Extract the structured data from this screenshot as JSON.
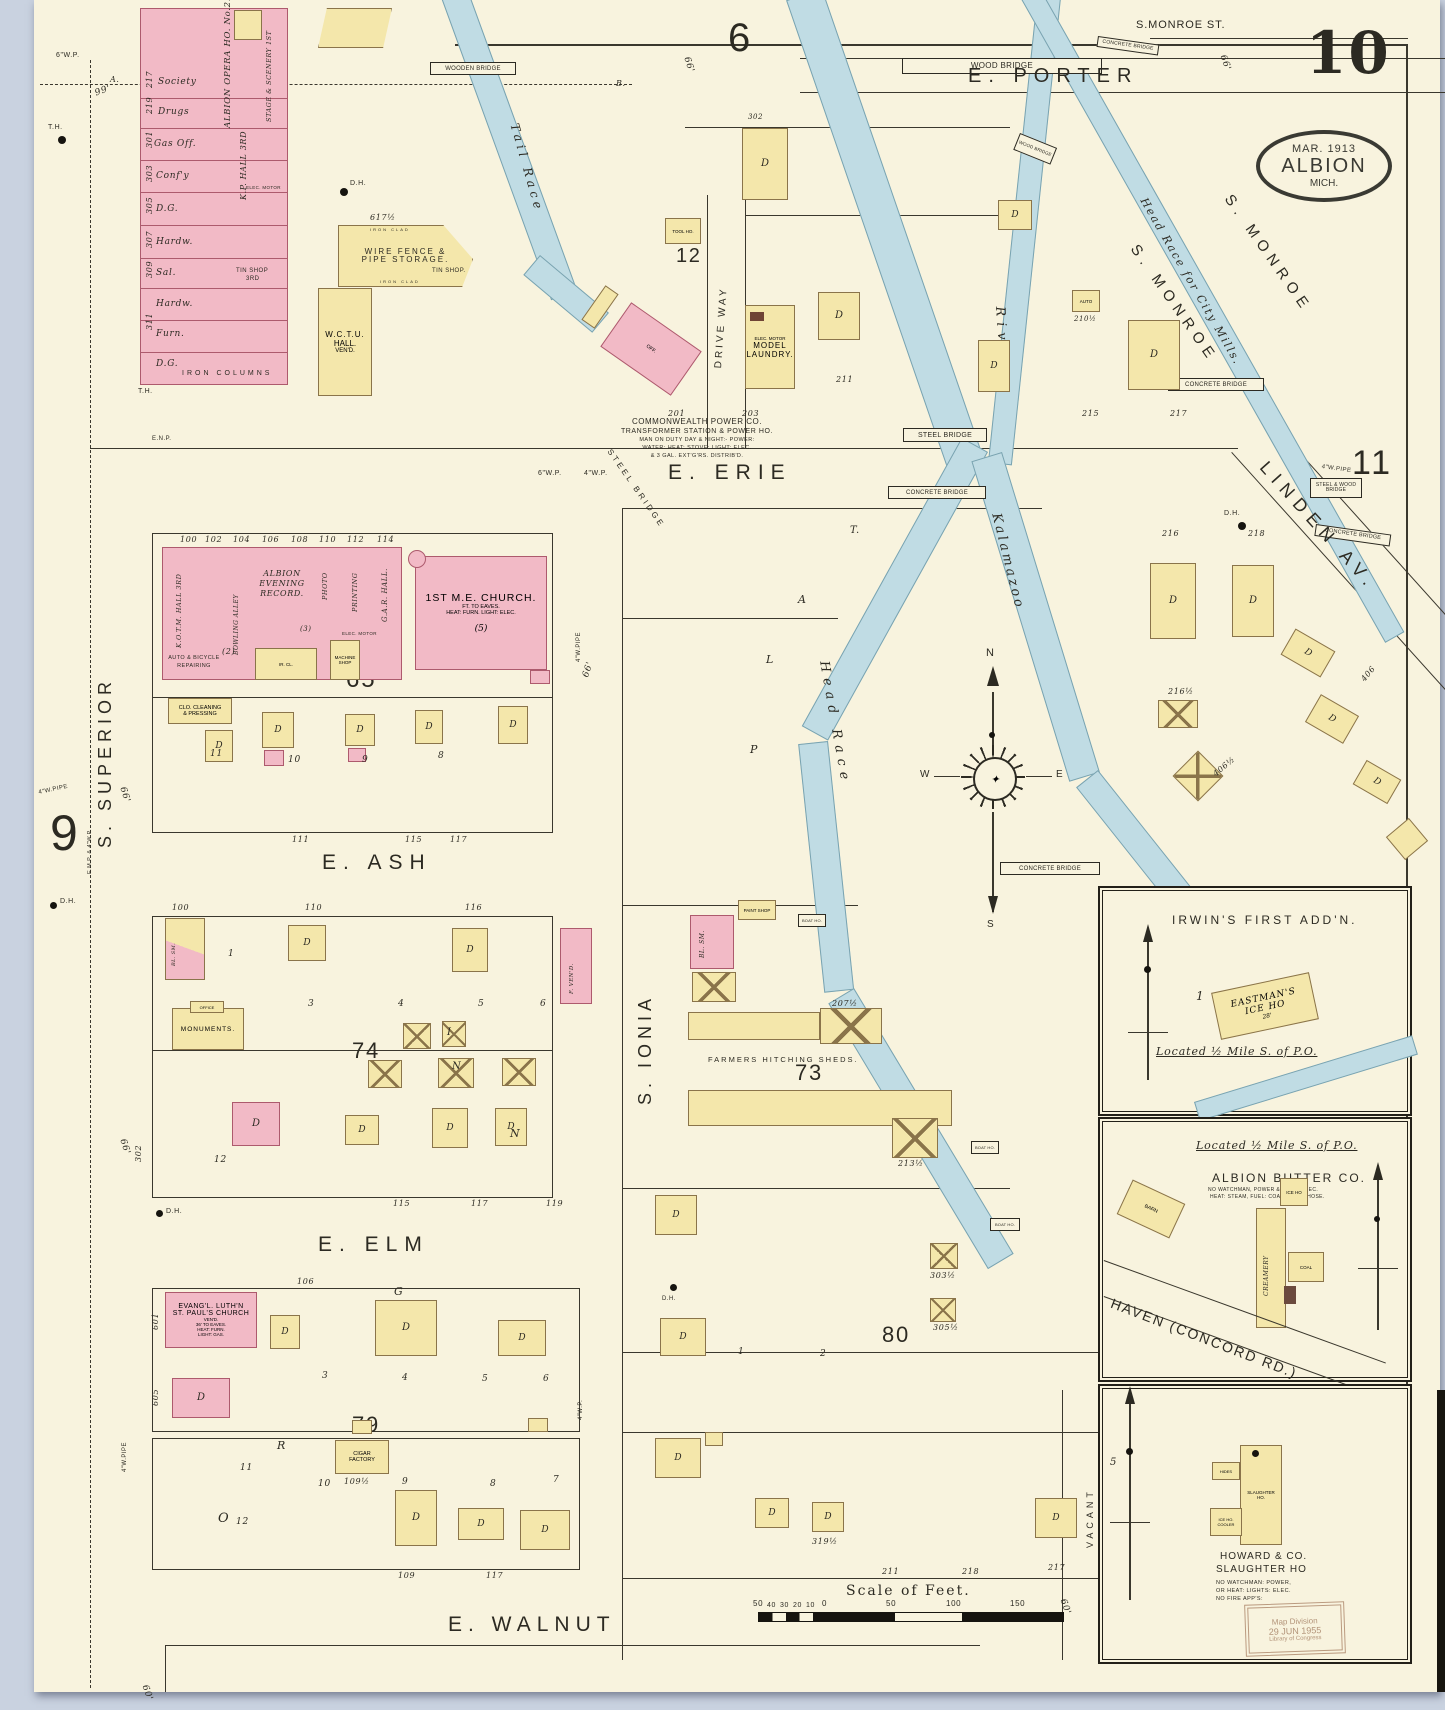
{
  "sheet": {
    "number": "10",
    "stamp": {
      "date": "MAR. 1913",
      "city": "ALBION",
      "state": "MICH."
    },
    "library_stamp": {
      "l1": "Map Division",
      "l2": "29 JUN 1955",
      "l3": "Library of Congress"
    }
  },
  "adjacent": {
    "top": "6",
    "left": "9",
    "right": "11"
  },
  "blocks": {
    "b12": "12",
    "b65": "65",
    "b73": "73",
    "b74": "74",
    "b79": "79",
    "b80": "80"
  },
  "streets": {
    "monroe_st": "S.MONROE ST.",
    "porter": "E. PORTER",
    "erie": "E. ERIE",
    "ash": "E. ASH",
    "elm": "E. ELM",
    "walnut": "E. WALNUT",
    "superior": "S. SUPERIOR",
    "ionia": "S. IONIA",
    "monroe": "S. MONROE",
    "linden": "LINDEN AV.",
    "driveway": "DRIVE WAY",
    "haven": "HAVEN (CONCORD RD.)",
    "vacant": "VACANT"
  },
  "water": {
    "tail": "Tail Race",
    "river": "River.",
    "kalamazoo": "Kalamazoo",
    "head": "Head Race",
    "mills": "Head Race for City Mills.",
    "pond1": "Kalamazoo River.",
    "pond2": "Mill Pond."
  },
  "bridges": {
    "wood": "WOOD BRIDGE",
    "wooden": "WOODEN BRIDGE",
    "steel": "STEEL BRIDGE",
    "concrete": "CONCRETE BRIDGE",
    "steel_wood": "STEEL & WOOD BRIDGE"
  },
  "buildings": {
    "society": "Society",
    "drugs": "Drugs",
    "gas_off": "Gas Off.",
    "confy": "Conf'y",
    "dg": "D.G.",
    "hardw": "Hardw.",
    "sal": "Sal.",
    "furn": "Furn.",
    "iron_col": "IRON COLUMNS",
    "opera": "ALBION OPERA HO. No.2. 2ND",
    "stage": "STAGE & SCENERY 1ST",
    "kp": "K.P. HALL 3RD",
    "tin3a": "TIN SHOP",
    "tin3b": "3RD",
    "elec": "ELEC. MOTOR",
    "wire1": "WIRE FENCE &",
    "wire2": "PIPE STORAGE.",
    "tin": "TIN SHOP.",
    "ironclad": "IRON CLAD",
    "wctu1": "W.C.T.U.",
    "wctu2": "HALL.",
    "wctu3": "VEN'D.",
    "tool": "TOOL HO.",
    "k": "K.",
    "laun1": "MODEL",
    "laun2": "LAUNDRY.",
    "cp1": "COMMONWEALTH POWER CO.",
    "cp2": "TRANSFORMER STATION & POWER HO.",
    "cp3": "MAN ON DUTY DAY & NIGHT:- POWER:",
    "cp4": "WATER: HEAT: STOVE: LIGHT: ELEC.",
    "cp5": "& 3 GAL. EXT'G'RS. DISTRIB'D.",
    "off": "OFF.",
    "kotm": "K.O.T.M. HALL 3RD",
    "bowl": "BOWLING ALLEY",
    "rec1": "ALBION",
    "rec2": "EVENING",
    "rec3": "RECORD.",
    "photo": "PHOTO",
    "print": "PRINTING",
    "gar": "G.A.R. HALL.",
    "mach1": "MACHINE",
    "mach2": "SHOP",
    "ircl": "IR. CL.",
    "me1": "1ST M.E. CHURCH.",
    "me2": "FT. TO EAVES.",
    "me3": "HEAT: FURN. LIGHT: ELEC.",
    "me4": "(5)",
    "rep1": "AUTO & BICYCLE",
    "rep2": "REPAIRING",
    "clean1": "CLO. CLEANING",
    "clean2": "& PRESSING",
    "monu": "MONUMENTS.",
    "office": "OFFICE",
    "blsm": "BL. SM.",
    "fvend": "F. VEN'D.",
    "paint": "PAINT SHOP",
    "boat": "BOAT HO.",
    "farmers": "FARMERS HITCHING SHEDS.",
    "luth1": "EVANG'L. LUTH'N",
    "luth2": "ST. PAUL'S CHURCH",
    "luth3": "VEN'D.",
    "luth4": "36' TO EAVES.",
    "luth5": "HEAT: FURN.",
    "luth6": "LIGHT: GAS.",
    "cig1": "CIGAR",
    "cig2": "FACTORY",
    "auto": "AUTO",
    "d": "D"
  },
  "insets": {
    "irwins": {
      "title": "IRWIN'S FIRST ADD'N.",
      "e1": "EASTMAN'S",
      "e2": "ICE HO",
      "dim": "28'",
      "located": "Located ½ Mile S. of P.O.",
      "lot": "1"
    },
    "butter": {
      "located": "Located ½ Mile S. of P.O.",
      "title": "ALBION BUTTER CO.",
      "sub1": "NO WATCHMAN, POWER & LIGHT: ELEC.",
      "sub2": "HEAT: STEAM, FUEL: COAL, SMALL HOSE.",
      "creamery": "CREAMERY",
      "ice": "ICE HO",
      "coal": "COAL",
      "barn": "BARN"
    },
    "howard": {
      "t1": "HOWARD & CO.",
      "t2": "SLAUGHTER HO",
      "s1": "NO WATCHMAN: POWER,",
      "s2": "OR HEAT: LIGHTS: ELEC.",
      "s3": "NO FIRE APP'S:",
      "hides": "HIDES",
      "slh1": "SLAUGHTER",
      "slh2": "HO.",
      "ice": "ICE HO.",
      "cooler": "COOLER"
    }
  },
  "compass": {
    "n": "N",
    "e": "E",
    "w": "W",
    "s": "S"
  },
  "scale_bar": {
    "title": "Scale of Feet.",
    "ticks": [
      "50",
      "40",
      "30",
      "20",
      "10",
      "0",
      "50",
      "100",
      "150"
    ]
  },
  "notes": {
    "dh": "D.H.",
    "th": "T.H.",
    "a": "A.",
    "b": "B.",
    "wp6": "6\"W.P.",
    "wp4": "4\"W.P.",
    "wpipe4": "4\"W.PIPE",
    "emp": "E.M.P. & 4\"W.P.",
    "enp": "E.N.P.",
    "ft66": "66'",
    "ft60": "60'",
    "ft99": "99'",
    "p": "P",
    "l": "L",
    "aa": "A",
    "t": "T.",
    "n": "N",
    "g": "G",
    "r": "R",
    "o": "O",
    "i": "I",
    "p2": "(2)",
    "p3": "(3)"
  },
  "hn": {
    "h217": "217",
    "h219": "219",
    "h301": "301",
    "h303": "303",
    "h305": "305",
    "h307": "307",
    "h309": "309",
    "h311": "311",
    "h100": "100",
    "h102": "102",
    "h104": "104",
    "h106": "106",
    "h108": "108",
    "h110": "110",
    "h112": "112",
    "h114": "114",
    "h111": "111",
    "h115": "115",
    "h117": "117",
    "h100b": "100",
    "h110b": "110",
    "h116": "116",
    "h115b": "115",
    "h117c": "117",
    "h119": "119",
    "h106b": "106",
    "h302": "302",
    "h601": "601",
    "h605": "605",
    "h109h": "109½",
    "h109": "109",
    "h117b": "117",
    "h617h": "617½",
    "h201": "201",
    "h203": "203",
    "h211": "211",
    "h215": "215",
    "h217b": "217",
    "h210h": "210½",
    "h216": "216",
    "h218": "218",
    "h216h": "216½",
    "h406": "406",
    "h406h": "406½",
    "h207h": "207½",
    "h213h": "213½",
    "h303h": "303½",
    "h305h": "305½",
    "h319h": "319½",
    "h211b": "211",
    "h218b": "218",
    "h217d": "217"
  },
  "lots": {
    "l1": "1",
    "l2": "2",
    "l3": "3",
    "l4": "4",
    "l5": "5",
    "l6": "6",
    "l7": "7",
    "l8": "8",
    "l9": "9",
    "l10": "10",
    "l11": "11",
    "l12": "12"
  },
  "story": {
    "s1": "1",
    "s2": "2",
    "s3": "3"
  }
}
